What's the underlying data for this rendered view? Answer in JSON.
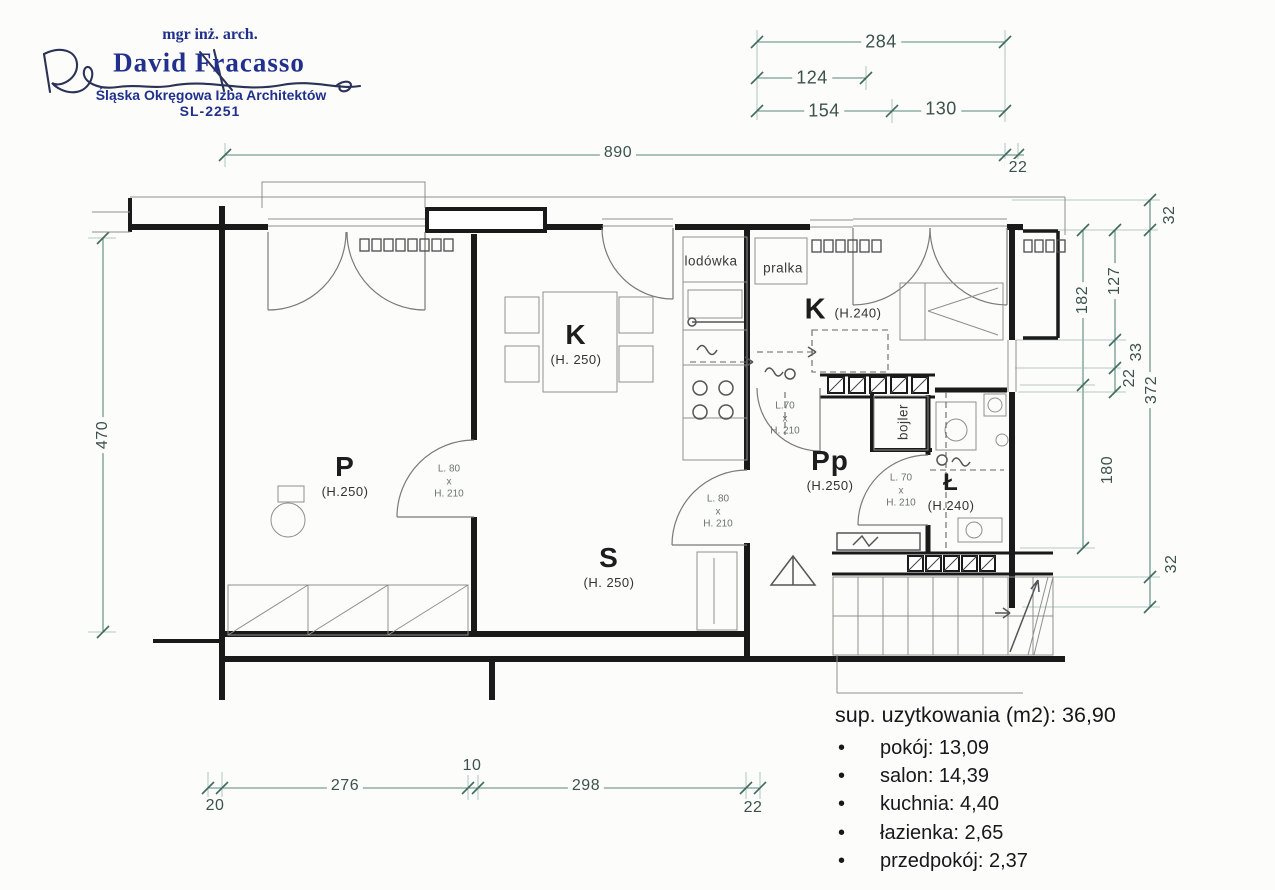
{
  "stamp": {
    "title": "mgr inż. arch.",
    "name": "David Fracasso",
    "chamber": "Śląska Okręgowa Izba Architektów",
    "license": "SL-2251"
  },
  "dims": {
    "top_right_total": "284",
    "top_right_inner": "124",
    "top_right_seg1": "154",
    "top_right_seg2": "130",
    "plan_width": "890",
    "plan_width_offset": "22",
    "left_height": "470",
    "right_32_top": "32",
    "right_127": "127",
    "right_182": "182",
    "right_33": "33",
    "right_22": "22",
    "right_372": "372",
    "right_180": "180",
    "right_32_bottom": "32",
    "bottom_20": "20",
    "bottom_276": "276",
    "bottom_10": "10",
    "bottom_298": "298",
    "bottom_22": "22"
  },
  "rooms": {
    "p": {
      "letter": "P",
      "height": "(H.250)"
    },
    "k_dining": {
      "letter": "K",
      "height": "(H. 250)"
    },
    "s": {
      "letter": "S",
      "height": "(H. 250)"
    },
    "k_kitchen": {
      "letter": "K",
      "height": "(H.240)"
    },
    "pp": {
      "letter": "Pp",
      "height": "(H.250)"
    },
    "bath": {
      "letter": "Ł",
      "height": "(H.240)"
    }
  },
  "labels": {
    "fridge": "lodówka",
    "washer": "pralka",
    "boiler": "bojler"
  },
  "doors": {
    "p": {
      "width": "L. 80",
      "sep": "x",
      "height": "H. 210"
    },
    "s": {
      "width": "L. 80",
      "sep": "x",
      "height": "H. 210"
    },
    "pp": {
      "width": "L.70",
      "sep": "x",
      "height": "H. 210"
    },
    "bath": {
      "width": "L. 70",
      "sep": "x",
      "height": "H. 210"
    }
  },
  "summary": {
    "title": "sup. uzytkowania (m2): 36,90",
    "bullet": "•",
    "items": [
      {
        "name": "pokój",
        "value": "13,09",
        "display": "pokój: 13,09"
      },
      {
        "name": "salon",
        "value": "14,39",
        "display": "salon: 14,39"
      },
      {
        "name": "kuchnia",
        "value": "4,40",
        "display": "kuchnia: 4,40"
      },
      {
        "name": "łazienka",
        "value": "2,65",
        "display": "łazienka: 2,65"
      },
      {
        "name": "przedpokój",
        "value": "2,37",
        "display": "przedpokój: 2,37"
      }
    ]
  },
  "colors": {
    "paper": "#fcfcfa",
    "wall": "#1a1a1a",
    "thin_line": "#8f8f8c",
    "dim_line": "#5a897d",
    "dim_text": "#3c524d",
    "door_label": "#6a7470",
    "stamp_navy": "#20308c",
    "signature": "#2b3258",
    "text_dark": "#17181b"
  }
}
